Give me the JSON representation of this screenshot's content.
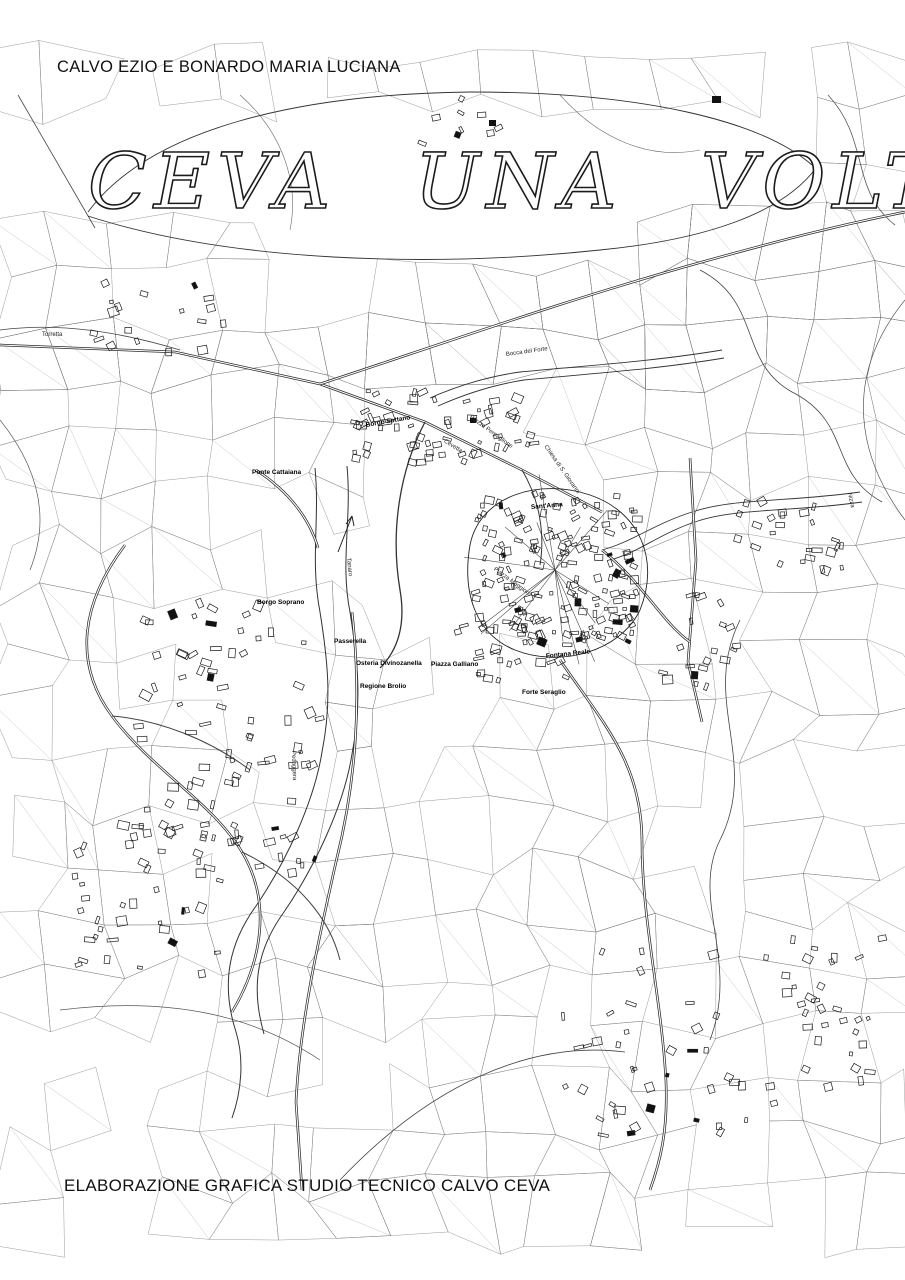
{
  "header": {
    "author": "CALVO EZIO E BONARDO MARIA LUCIANA"
  },
  "title": "CEVA UNA VOLTA",
  "footer": {
    "credit": "ELABORAZIONE GRAFICA STUDIO TECNICO CALVO CEVA"
  },
  "map": {
    "ink_color": "#1a1a1a",
    "background_color": "#ffffff",
    "labels": [
      {
        "text": "Bocca del Forte"
      },
      {
        "text": "Borgo Sottano"
      },
      {
        "text": "Piazza Perpaglione"
      },
      {
        "text": "Ponte Cattaiana"
      },
      {
        "text": "Chiesa di S. Giovanni"
      },
      {
        "text": "Sant'Anna"
      },
      {
        "text": "Piazza Maggiore"
      },
      {
        "text": "Borgo Soprano"
      },
      {
        "text": "Passerella"
      },
      {
        "text": "Osteria Divinozanella"
      },
      {
        "text": "Piazza Galliano"
      },
      {
        "text": "Regione Brolio"
      },
      {
        "text": "Fontana Reale"
      },
      {
        "text": "Forte Seraglio"
      },
      {
        "text": "Torretta"
      },
      {
        "text": "Tanaro"
      },
      {
        "text": "Cevetta"
      },
      {
        "text": "Nizza"
      },
      {
        "text": "Pedaggera"
      }
    ]
  }
}
